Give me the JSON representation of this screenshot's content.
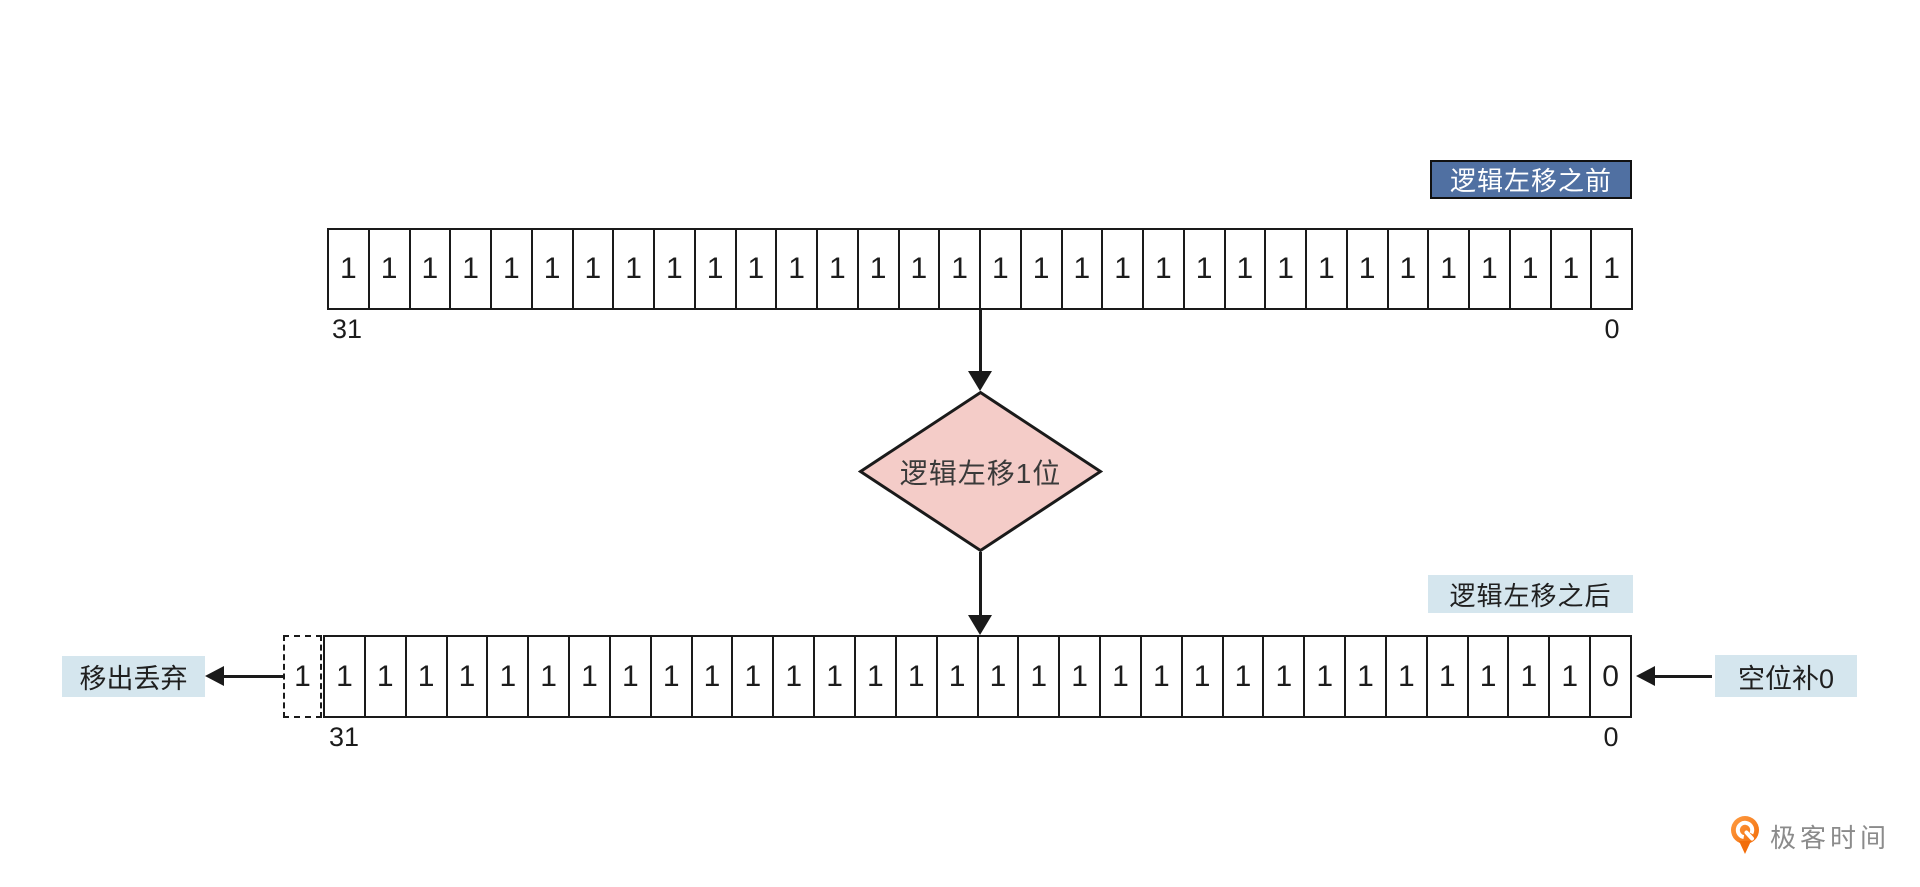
{
  "diagram": {
    "title_before": "逻辑左移之前",
    "title_after": "逻辑左移之后",
    "operation": "逻辑左移1位",
    "annotation_left": "移出丢弃",
    "annotation_right": "空位补0"
  },
  "registers": {
    "before": {
      "bits": [
        "1",
        "1",
        "1",
        "1",
        "1",
        "1",
        "1",
        "1",
        "1",
        "1",
        "1",
        "1",
        "1",
        "1",
        "1",
        "1",
        "1",
        "1",
        "1",
        "1",
        "1",
        "1",
        "1",
        "1",
        "1",
        "1",
        "1",
        "1",
        "1",
        "1",
        "1",
        "1"
      ],
      "msb_index": "31",
      "lsb_index": "0"
    },
    "after": {
      "overflow_bit": "1",
      "bits": [
        "1",
        "1",
        "1",
        "1",
        "1",
        "1",
        "1",
        "1",
        "1",
        "1",
        "1",
        "1",
        "1",
        "1",
        "1",
        "1",
        "1",
        "1",
        "1",
        "1",
        "1",
        "1",
        "1",
        "1",
        "1",
        "1",
        "1",
        "1",
        "1",
        "1",
        "1",
        "0"
      ],
      "msb_index": "31",
      "lsb_index": "0"
    }
  },
  "colors": {
    "line": "#1a1a1a",
    "tag_blue_bg": "#5070a2",
    "tag_blue_text": "#ffffff",
    "light_blue_bg": "#d5e6ee",
    "diamond_fill": "#f4ccc8",
    "logo_orange": "#f8781f",
    "logo_text_gray": "#8b8b8b"
  },
  "logo": {
    "text": "极客时间",
    "icon": "geektime-pin-icon"
  }
}
